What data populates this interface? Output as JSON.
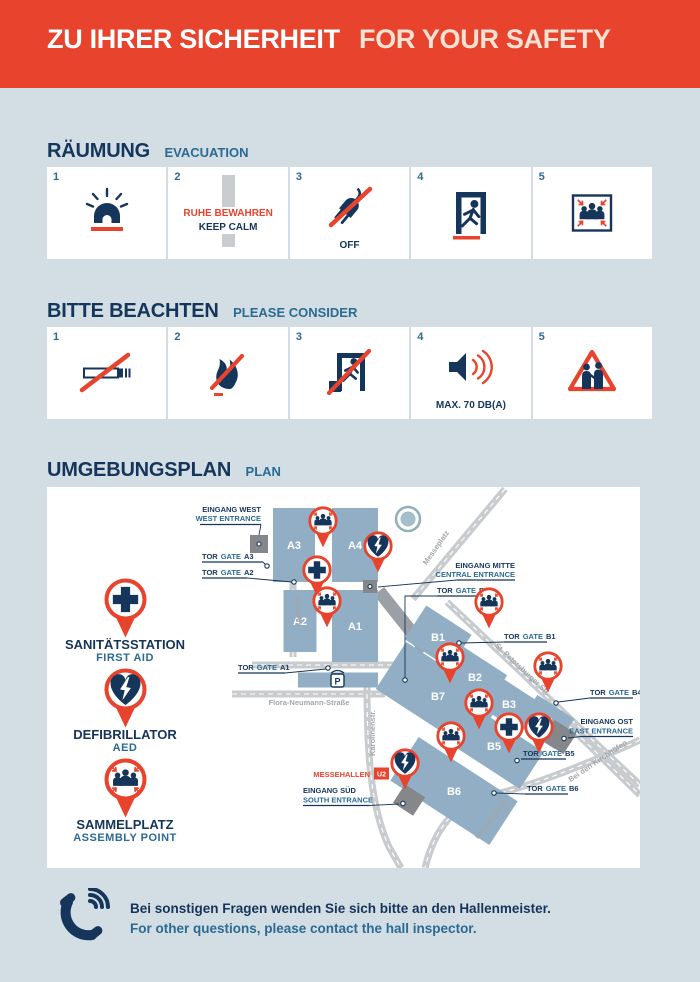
{
  "header": {
    "title_de": "ZU IHRER SICHERHEIT",
    "title_en": "FOR YOUR SAFETY"
  },
  "sections": {
    "evacuation": {
      "title_de": "RÄUMUNG",
      "title_en": "EVACUATION",
      "items": [
        {
          "number": "1",
          "icon": "siren"
        },
        {
          "number": "2",
          "icon": "keep-calm",
          "text_de": "RUHE BEWAHREN",
          "text_en": "KEEP CALM"
        },
        {
          "number": "3",
          "icon": "plug-off",
          "label": "OFF"
        },
        {
          "number": "4",
          "icon": "emergency-exit"
        },
        {
          "number": "5",
          "icon": "assembly-point"
        }
      ]
    },
    "consider": {
      "title_de": "BITTE BEACHTEN",
      "title_en": "PLEASE CONSIDER",
      "items": [
        {
          "number": "1",
          "icon": "no-smoking"
        },
        {
          "number": "2",
          "icon": "no-open-fire"
        },
        {
          "number": "3",
          "icon": "keep-exits-clear"
        },
        {
          "number": "4",
          "icon": "volume-limit",
          "label": "MAX. 70 DB(A)"
        },
        {
          "number": "5",
          "icon": "beware-pickpockets"
        }
      ]
    },
    "plan": {
      "title_de": "UMGEBUNGSPLAN",
      "title_en": "PLAN"
    }
  },
  "legend": [
    {
      "type": "first-aid",
      "de": "SANITÄTSSTATION",
      "en": "FIRST AID"
    },
    {
      "type": "defibrillator",
      "de": "DEFIBRILLATOR",
      "en": "AED"
    },
    {
      "type": "assembly",
      "de": "SAMMELPLATZ",
      "en": "ASSEMBLY  POINT"
    }
  ],
  "map": {
    "gate_label_de": "TOR",
    "gate_label_en": "GATE",
    "gates": [
      {
        "id": "A3"
      },
      {
        "id": "A2"
      },
      {
        "id": "A1"
      },
      {
        "id": "B7"
      },
      {
        "id": "B1"
      },
      {
        "id": "B4"
      },
      {
        "id": "B5"
      },
      {
        "id": "B6"
      }
    ],
    "entrances": [
      {
        "de": "EINGANG WEST",
        "en": "WEST ENTRANCE"
      },
      {
        "de": "EINGANG MITTE",
        "en": "CENTRAL ENTRANCE"
      },
      {
        "de": "EINGANG OST",
        "en": "EAST ENTRANCE"
      },
      {
        "de": "EINGANG SÜD",
        "en": "SOUTH ENTRANCE"
      }
    ],
    "streets": [
      "Lagerstr.",
      "Messeplatz",
      "St. Petersburger Str.",
      "Flora-Neumann-Straße",
      "Karolinenstr.",
      "Bei den Kirchhöfen",
      "Holstenglacis"
    ],
    "station": {
      "name": "MESSEHALLEN",
      "line": "U2"
    },
    "parking": "P",
    "halls": [
      {
        "label": "A3",
        "cx": 247,
        "cy": 58,
        "w": 42,
        "h": 74,
        "angle": 0
      },
      {
        "label": "A4",
        "cx": 308,
        "cy": 58,
        "w": 46,
        "h": 74,
        "angle": 0
      },
      {
        "label": "A2",
        "cx": 253,
        "cy": 134,
        "w": 33,
        "h": 62,
        "angle": 0
      },
      {
        "label": "A1",
        "cx": 308,
        "cy": 139,
        "w": 46,
        "h": 72,
        "angle": 0
      },
      {
        "label": "",
        "cx": 291,
        "cy": 193,
        "w": 80,
        "h": 15,
        "angle": 0
      },
      {
        "label": "B1",
        "cx": 391,
        "cy": 150,
        "w": 54,
        "h": 40,
        "angle": 33
      },
      {
        "label": "B2",
        "cx": 428,
        "cy": 190,
        "w": 52,
        "h": 38,
        "angle": 33
      },
      {
        "label": "B3",
        "cx": 462,
        "cy": 217,
        "w": 52,
        "h": 36,
        "angle": 33
      },
      {
        "label": "B4",
        "cx": 499,
        "cy": 235,
        "w": 44,
        "h": 36,
        "angle": 33
      },
      {
        "label": "B7",
        "cx": 391,
        "cy": 209,
        "w": 112,
        "h": 56,
        "angle": 33
      },
      {
        "label": "B5",
        "cx": 447,
        "cy": 259,
        "w": 90,
        "h": 44,
        "angle": 33
      },
      {
        "label": "B6",
        "cx": 407,
        "cy": 304,
        "w": 118,
        "h": 52,
        "angle": 33
      }
    ],
    "pins": [
      {
        "type": "assembly",
        "x": 276,
        "y": 34
      },
      {
        "type": "defibrillator",
        "x": 331,
        "y": 59
      },
      {
        "type": "first-aid",
        "x": 270,
        "y": 83
      },
      {
        "type": "assembly",
        "x": 280,
        "y": 114
      },
      {
        "type": "assembly",
        "x": 442,
        "y": 115
      },
      {
        "type": "assembly",
        "x": 403,
        "y": 170
      },
      {
        "type": "assembly",
        "x": 501,
        "y": 179
      },
      {
        "type": "assembly",
        "x": 432,
        "y": 216
      },
      {
        "type": "first-aid",
        "x": 462,
        "y": 240
      },
      {
        "type": "defibrillator",
        "x": 492,
        "y": 240
      },
      {
        "type": "assembly",
        "x": 404,
        "y": 249
      },
      {
        "type": "defibrillator",
        "x": 358,
        "y": 276
      }
    ]
  },
  "footer": {
    "text_de": "Bei sonstigen Fragen wenden Sie sich bitte an den Hallenmeister.",
    "text_en": "For other questions, please contact the hall inspector."
  },
  "colors": {
    "red": "#e8432c",
    "navy": "#16355a",
    "blue": "#2b6a92",
    "hall": "#91aec5",
    "page": "#d2dde4",
    "cream": "#f6e2d3"
  }
}
